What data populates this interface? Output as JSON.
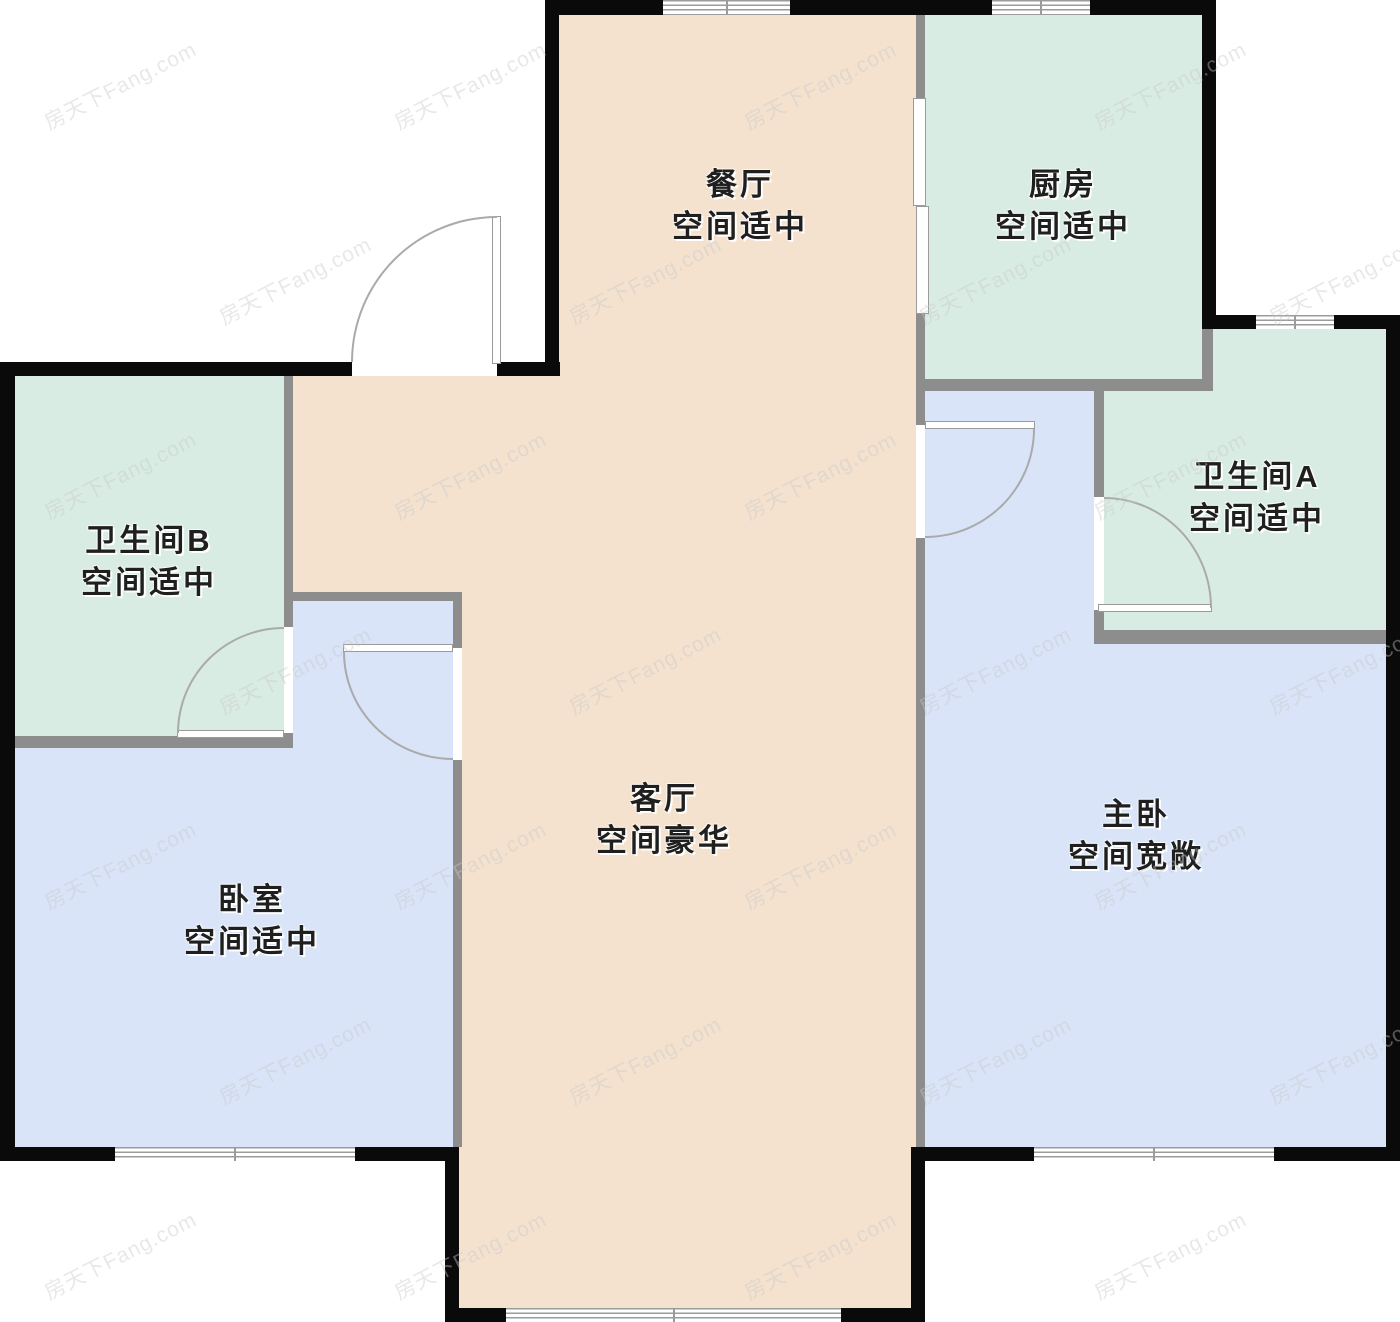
{
  "watermark": {
    "text": "房天下Fang.com"
  },
  "palette": {
    "outer_wall": "#0a0a0a",
    "inner_wall": "#8d8d8d",
    "living_dining_fill": "#f4e2cf",
    "kitchen_bath_fill": "#d9ece3",
    "bedroom_fill": "#d9e4f8",
    "door_line": "#aaaaaa",
    "window_line": "#9b9b9b"
  },
  "rooms": {
    "dining": {
      "name": "餐厅",
      "space": "空间适中"
    },
    "kitchen": {
      "name": "厨房",
      "space": "空间适中"
    },
    "bathroom_a": {
      "name": "卫生间A",
      "space": "空间适中"
    },
    "bathroom_b": {
      "name": "卫生间B",
      "space": "空间适中"
    },
    "living": {
      "name": "客厅",
      "space": "空间豪华"
    },
    "bedroom": {
      "name": "卧室",
      "space": "空间适中"
    },
    "master": {
      "name": "主卧",
      "space": "空间宽敞"
    }
  }
}
